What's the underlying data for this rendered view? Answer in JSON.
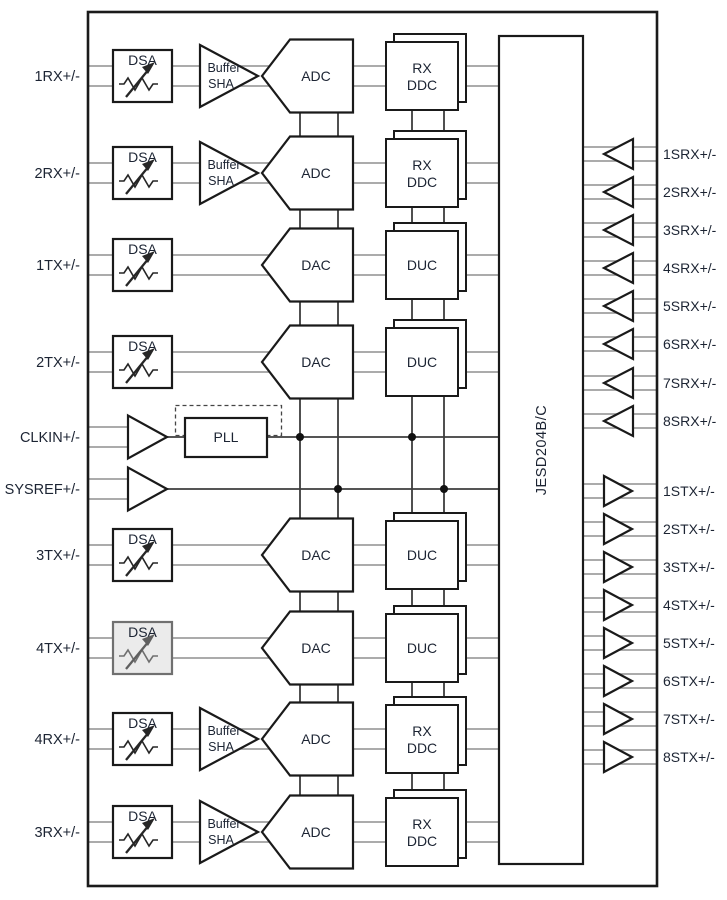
{
  "diagram": {
    "rows": [
      {
        "port": "1RX+/-",
        "kind": "rx",
        "dsa": "DSA",
        "amp": [
          "Buffer",
          "SHA"
        ],
        "converter": "ADC",
        "dsp": [
          "RX",
          "DDC"
        ],
        "dsa_disabled": false
      },
      {
        "port": "2RX+/-",
        "kind": "rx",
        "dsa": "DSA",
        "amp": [
          "Buffer",
          "SHA"
        ],
        "converter": "ADC",
        "dsp": [
          "RX",
          "DDC"
        ],
        "dsa_disabled": false
      },
      {
        "port": "1TX+/-",
        "kind": "tx",
        "dsa": "DSA",
        "converter": "DAC",
        "dsp": [
          "DUC"
        ],
        "dsa_disabled": false
      },
      {
        "port": "2TX+/-",
        "kind": "tx",
        "dsa": "DSA",
        "converter": "DAC",
        "dsp": [
          "DUC"
        ],
        "dsa_disabled": false
      },
      {
        "port": "CLKIN+/-",
        "kind": "clock",
        "pll_label": "PLL"
      },
      {
        "port": "SYSREF+/-",
        "kind": "sysref"
      },
      {
        "port": "3TX+/-",
        "kind": "tx",
        "dsa": "DSA",
        "converter": "DAC",
        "dsp": [
          "DUC"
        ],
        "dsa_disabled": false
      },
      {
        "port": "4TX+/-",
        "kind": "tx",
        "dsa": "DSA",
        "converter": "DAC",
        "dsp": [
          "DUC"
        ],
        "dsa_disabled": true
      },
      {
        "port": "4RX+/-",
        "kind": "rx",
        "dsa": "DSA",
        "amp": [
          "Buffer",
          "SHA"
        ],
        "converter": "ADC",
        "dsp": [
          "RX",
          "DDC"
        ],
        "dsa_disabled": false
      },
      {
        "port": "3RX+/-",
        "kind": "rx",
        "dsa": "DSA",
        "amp": [
          "Buffer",
          "SHA"
        ],
        "converter": "ADC",
        "dsp": [
          "RX",
          "DDC"
        ],
        "dsa_disabled": false
      }
    ],
    "serdes": {
      "block_label": "JESD204B/C",
      "srx_ports": [
        "1SRX+/-",
        "2SRX+/-",
        "3SRX+/-",
        "4SRX+/-",
        "5SRX+/-",
        "6SRX+/-",
        "7SRX+/-",
        "8SRX+/-"
      ],
      "stx_ports": [
        "1STX+/-",
        "2STX+/-",
        "3STX+/-",
        "4STX+/-",
        "5STX+/-",
        "6STX+/-",
        "7STX+/-",
        "8STX+/-"
      ]
    },
    "colors": {
      "wire": "#8f8f8f",
      "trunk": "#3d3d3d",
      "block_border": "#1a1a1a",
      "text": "#1c2433",
      "disabled_fill": "#ebebeb",
      "disabled_border": "#707070",
      "background": "#ffffff"
    }
  }
}
